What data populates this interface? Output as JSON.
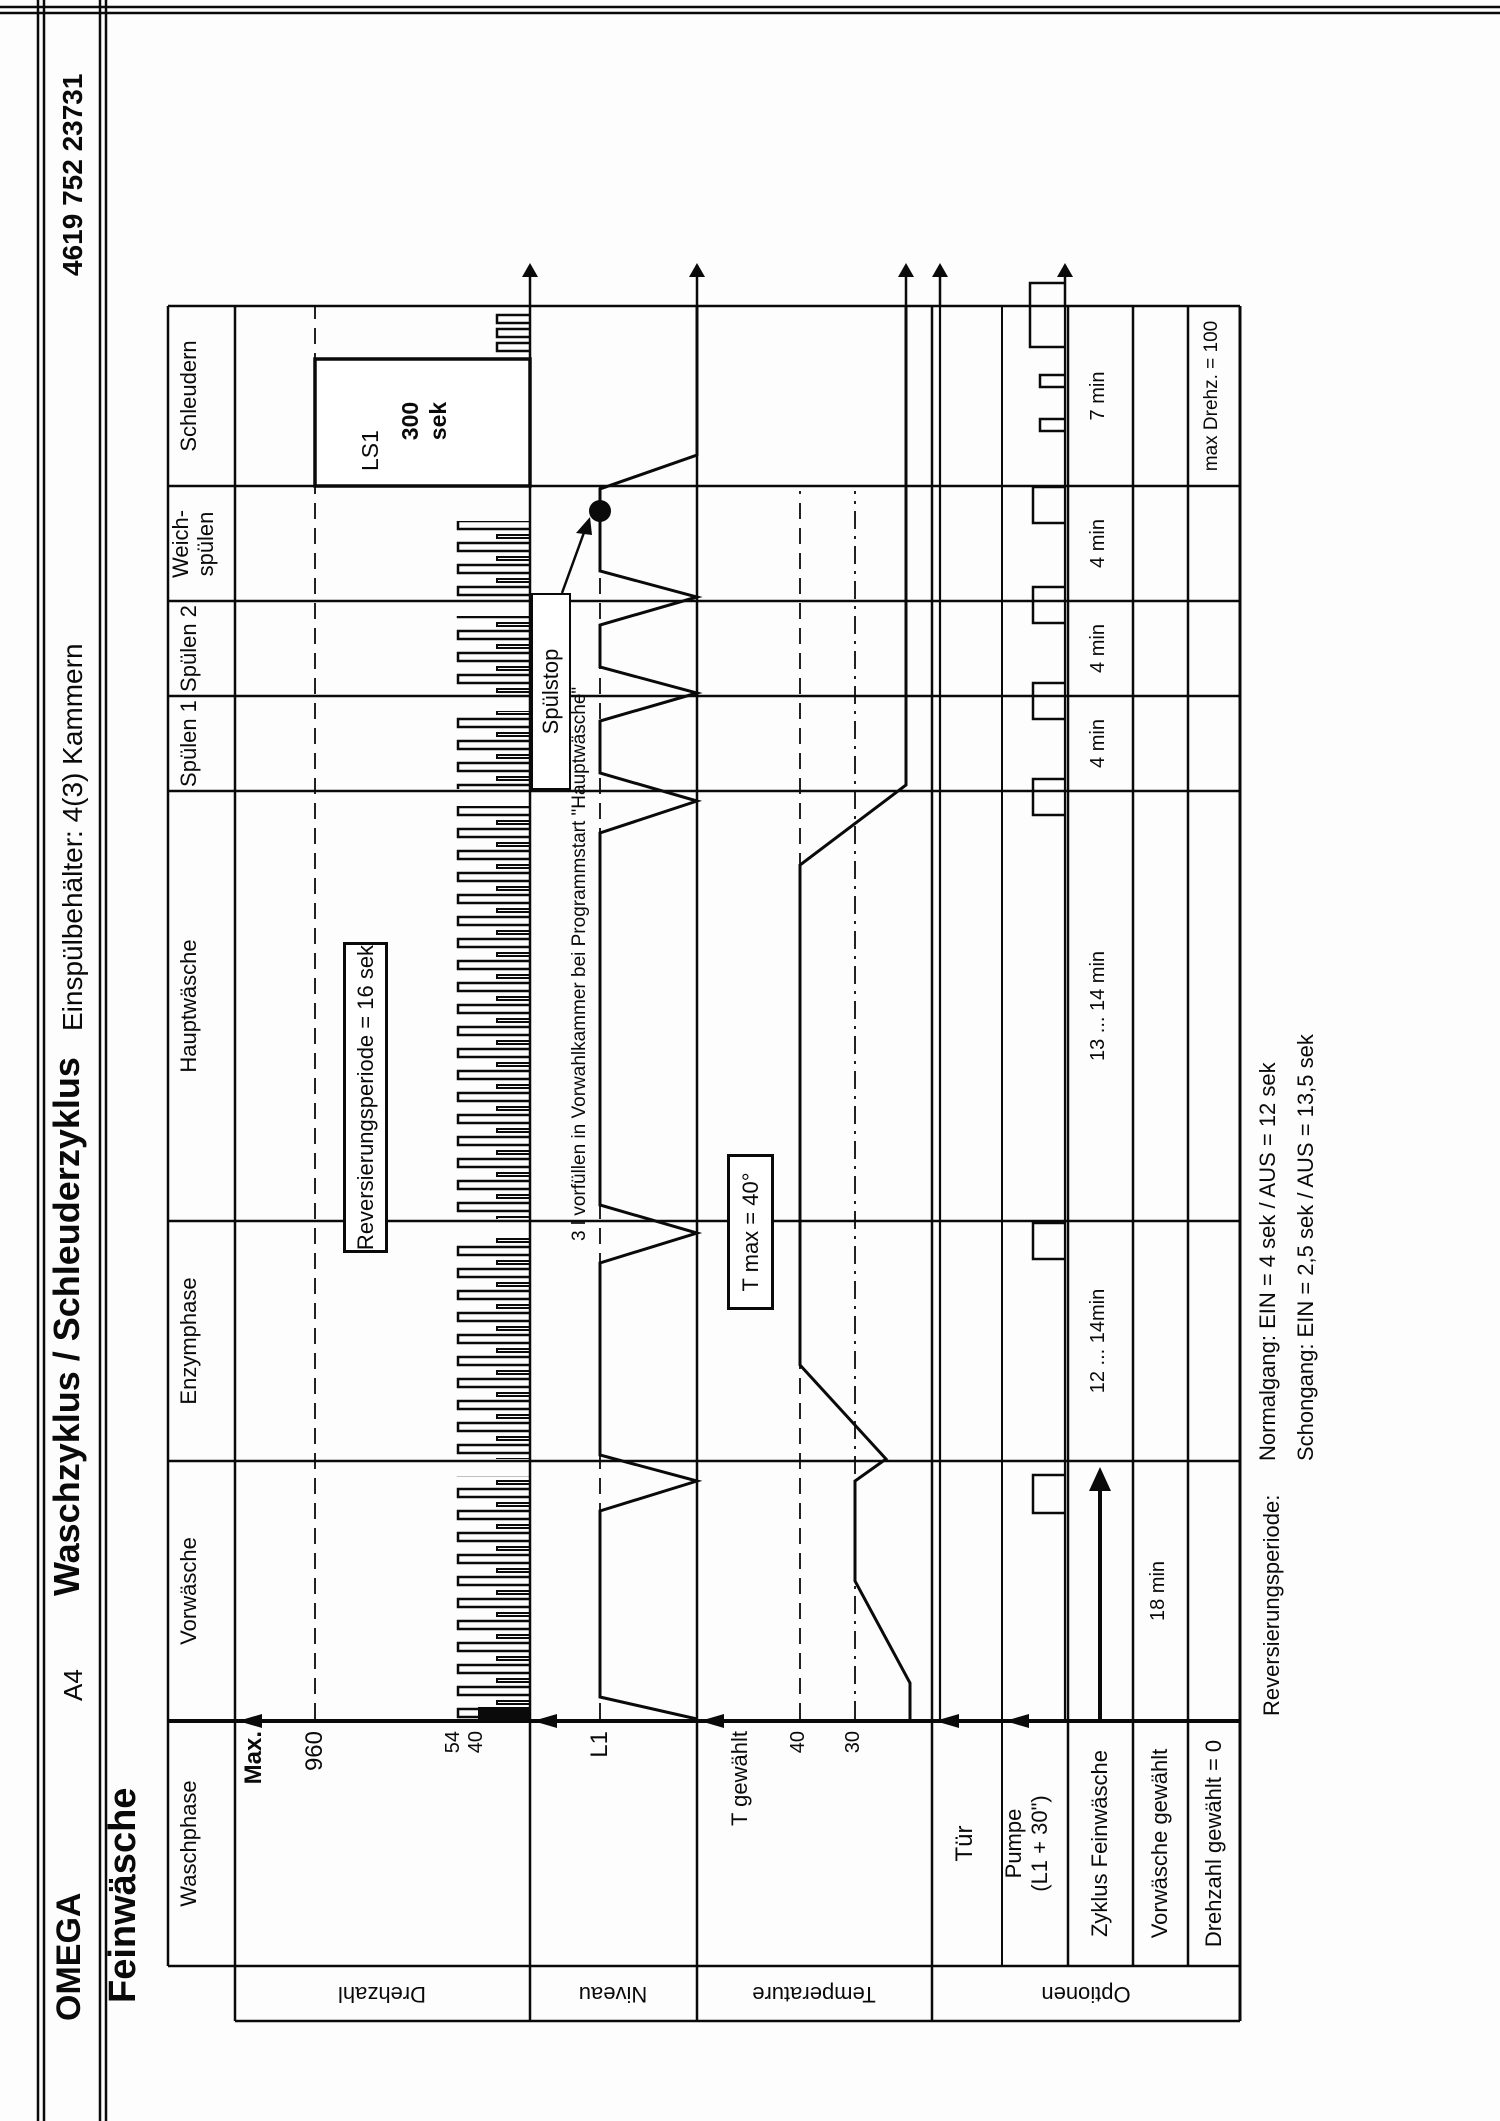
{
  "header": {
    "brand": "OMEGA",
    "format": "A4",
    "title": "Waschzyklus / Schleuderzyklus",
    "dispenser": "Einspülbehälter: 4(3) Kammern",
    "part_number": "4619 752 23731",
    "program": "Feinwäsche"
  },
  "phase_header": {
    "corner": "Waschphase",
    "phases": [
      "Vorwäsche",
      "Enzymphase",
      "Hauptwäsche",
      "Spülen 1",
      "Spülen 2",
      "Weich-spülen",
      "Schleudern"
    ]
  },
  "row_groups": {
    "drehzahl": "Drehzahl",
    "niveau": "Niveau",
    "temperature": "Temperature",
    "optionen": "Optionen"
  },
  "drehzahl": {
    "max_label": "Max.",
    "level_960": "960",
    "level_54": "54",
    "level_40": "40",
    "reversing_note": "Reversierungsperiode = 16 sek",
    "spin_box_name": "LS1",
    "spin_box_value": "300",
    "spin_box_unit": "sek"
  },
  "niveau": {
    "level_l1": "L1",
    "prefill_note": "3 l vorfüllen in Vorwahlkammer bei Programmstart \"Hauptwäsche\"",
    "spuelstop": "Spülstop"
  },
  "temperature": {
    "selected_label": "T gewählt",
    "level_40": "40",
    "level_30": "30",
    "tmax_note": "T max = 40°"
  },
  "options": {
    "tuer": "Tür",
    "pumpe_line1": "Pumpe",
    "pumpe_line2": "(L1 + 30\")",
    "zyklus": "Zyklus Feinwäsche",
    "vorwaesche_gewaehlt": "Vorwäsche gewählt",
    "drehzahl_gewaehlt": "Drehzahl gewählt = 0"
  },
  "durations": {
    "vorwaesche": "18 min",
    "enzymphase": "12 ... 14min",
    "hauptwaesche": "13 ... 14 min",
    "spuelen1": "4 min",
    "spuelen2": "4 min",
    "weichspuelen": "4 min",
    "schleudern": "7 min",
    "max_drehzahl_note": "max Drehz. = 100"
  },
  "footer": {
    "label": "Reversierungsperiode:",
    "normalgang": "Normalgang:  EIN = 4 sek  / AUS = 12 sek",
    "schongang": "Schongang:  EIN = 2,5 sek  / AUS = 13,5 sek"
  }
}
